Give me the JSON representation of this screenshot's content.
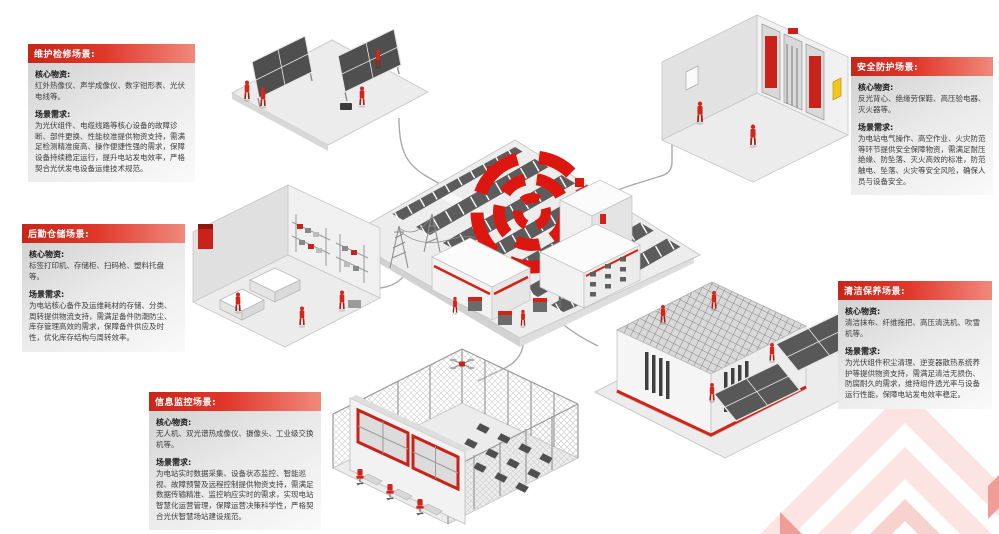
{
  "labels": {
    "core": "核心物资:",
    "need": "场景需求:"
  },
  "scenes": [
    {
      "id": "maintenance",
      "title": "维护检修场景:",
      "core": "红外热像仪、声学成像仪、数字钳形表、光伏电线等。",
      "need": "为光伏组件、电缆线路等核心设备的故障诊断、部件更换、性能校准提供物资支持，需满足检测精准度高、操作便捷性强的需求，保障设备持续稳定运行，提升电站发电效率，严格契合光伏发电设备运维技术规范。"
    },
    {
      "id": "logistics",
      "title": "后勤仓储场景:",
      "core": "标签打印机、存储柜、扫码枪、塑料托盘等。",
      "need": "为电站核心备件及运维耗材的存储、分类、周转提供物流支持，需满足备件防潮防尘、库存管理高效的需求，保障备件供应及时性，优化库存结构与周转效率。"
    },
    {
      "id": "monitoring",
      "title": "信息监控场景:",
      "core": "无人机、双光谱热成像仪、摄像头、工业级交换机等。",
      "need": "为电站实时数据采集、设备状态监控、智能巡视、故障预警及远程控制提供物资支持，需满足数据传输精准、监控响应实时的需求，实现电站智慧化运营管理，保障运营决策科学性，严格契合光伏智慧场站建设规范。"
    },
    {
      "id": "safety",
      "title": "安全防护场景:",
      "core": "反光背心、绝缘劳保鞋、高压验电器、灭火器等。",
      "need": "为电站电气操作、高空作业、火灾防范等环节提供安全保障物资，需满足耐压绝缘、防坠落、灭火高效的标准，防范触电、坠落、火灾等安全风险，确保人员与设备安全。"
    },
    {
      "id": "cleaning",
      "title": "清洁保养场景:",
      "core": "清洁抹布、纤维拖把、高压清洗机、吹雪机等。",
      "need": "为光伏组件积尘清理、逆变器散热系统养护等提供物资支持，需满足清洁无损伤、防腐耐久的需求，维持组件透光率与设备运行性能，保障电站发电效率稳定。"
    }
  ],
  "illustrations": {
    "center": "solar-farm",
    "top_left": "panel-maintenance-crew",
    "top_right": "electrical-protection-room",
    "middle_left": "logistics-warehouse",
    "bottom_center": "monitoring-control-room",
    "middle_right": "container-and-panel-cleaning"
  },
  "colors": {
    "accent_red": "#d42316",
    "header_gradient_start": "#c8261a",
    "header_gradient_end": "#f0897b",
    "panel_dark": "#5c5c5c",
    "platform_gray": "#ececec",
    "connector_gray": "#a9a9a9",
    "watermark_pink": "#fbe4e2",
    "worker_red": "#d3261a"
  }
}
